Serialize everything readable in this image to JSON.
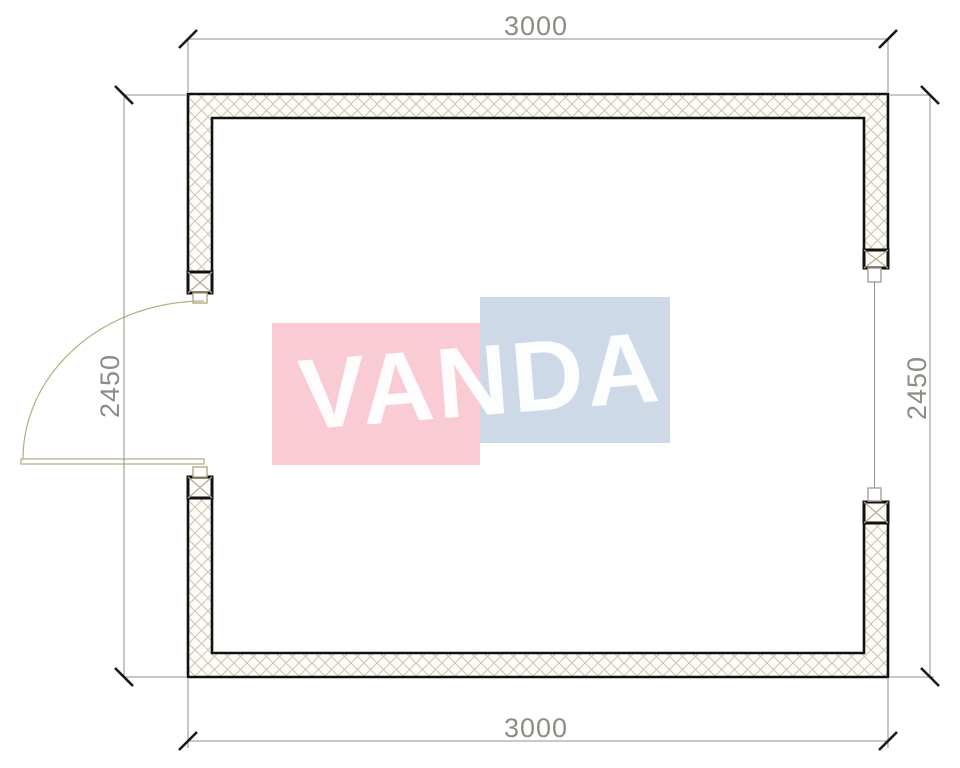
{
  "drawing": {
    "type": "floor-plan",
    "dimensions": {
      "top_label": "3000",
      "bottom_label": "3000",
      "left_label": "2450",
      "right_label": "2450"
    },
    "watermark": {
      "text": "VANDA",
      "pink_color": "#f9cbd4",
      "blue_color": "#cdd9e7",
      "text_color": "#ffffff"
    },
    "colors": {
      "background": "#ffffff",
      "wall_outline": "#111111",
      "wall_fill": "#fdfcf8",
      "wall_hatch": "#cdc5b2",
      "cap_hatch": "#b5ab97",
      "dimension_line": "#8f8f89",
      "dimension_text": "#7d7d76",
      "tick": "#1a1a1a",
      "door_frame": "#b4aa80",
      "door_swing": "#b9aa7e",
      "window_frame": "#a6a096"
    }
  }
}
